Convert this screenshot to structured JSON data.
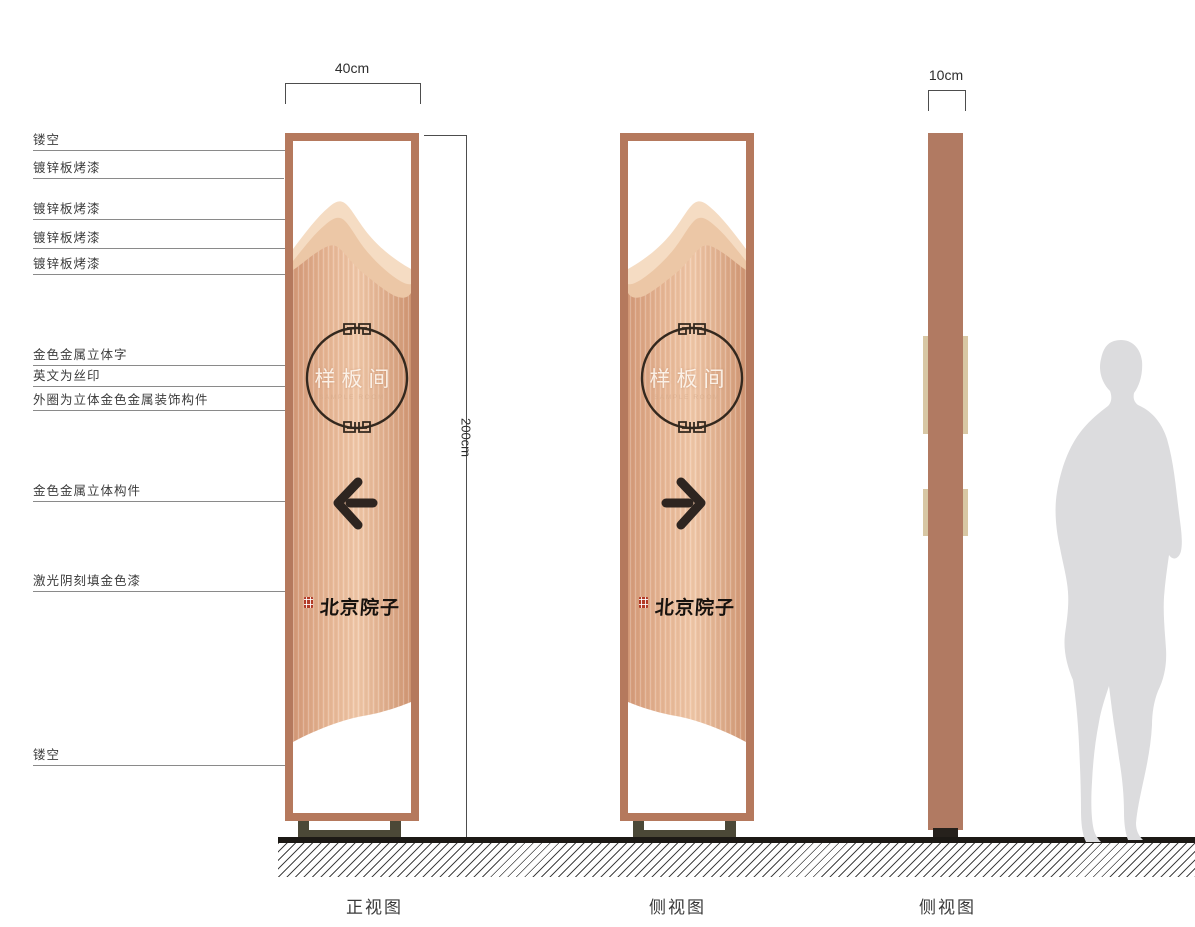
{
  "dimensions": {
    "front_width": "40cm",
    "height": "200cm",
    "side_depth": "10cm"
  },
  "annotations": [
    {
      "text": "镂空"
    },
    {
      "text": "镀锌板烤漆"
    },
    {
      "text": "镀锌板烤漆"
    },
    {
      "text": "镀锌板烤漆"
    },
    {
      "text": "镀锌板烤漆"
    },
    {
      "text": "金色金属立体字"
    },
    {
      "text": "英文为丝印"
    },
    {
      "text": "外圈为立体金色金属装饰构件"
    },
    {
      "text": "金色金属立体构件"
    },
    {
      "text": "激光阴刻填金色漆"
    },
    {
      "text": "镂空"
    }
  ],
  "views": {
    "front": "正视图",
    "side1": "侧视图",
    "side2": "侧视图"
  },
  "sign_content": {
    "room_name": "样板间",
    "room_name_en": "SAMPLE ROOM",
    "brand_name": "北京院子"
  },
  "icons": {
    "front_arrow": "arrow-left-icon",
    "side_arrow": "arrow-right-icon",
    "seal": "seal-stamp-icon",
    "ornament": "meander-ring-icon",
    "figure": "human-silhouette"
  },
  "colors": {
    "frame_copper": "#b5795d",
    "panel_grain_dark": "#d49a79",
    "panel_grain_light": "#f0c8a9",
    "mountain_back": "#f5dcc3",
    "mountain_mid": "#ecc7a6",
    "side_column": "#b17a62",
    "side_tab": "#d8c7a4",
    "base_bracket": "#4b4837",
    "ground": "#1c1915",
    "ink": "#2e2520",
    "seal_red": "#b23a26",
    "silhouette_gray": "#dcdcde"
  }
}
